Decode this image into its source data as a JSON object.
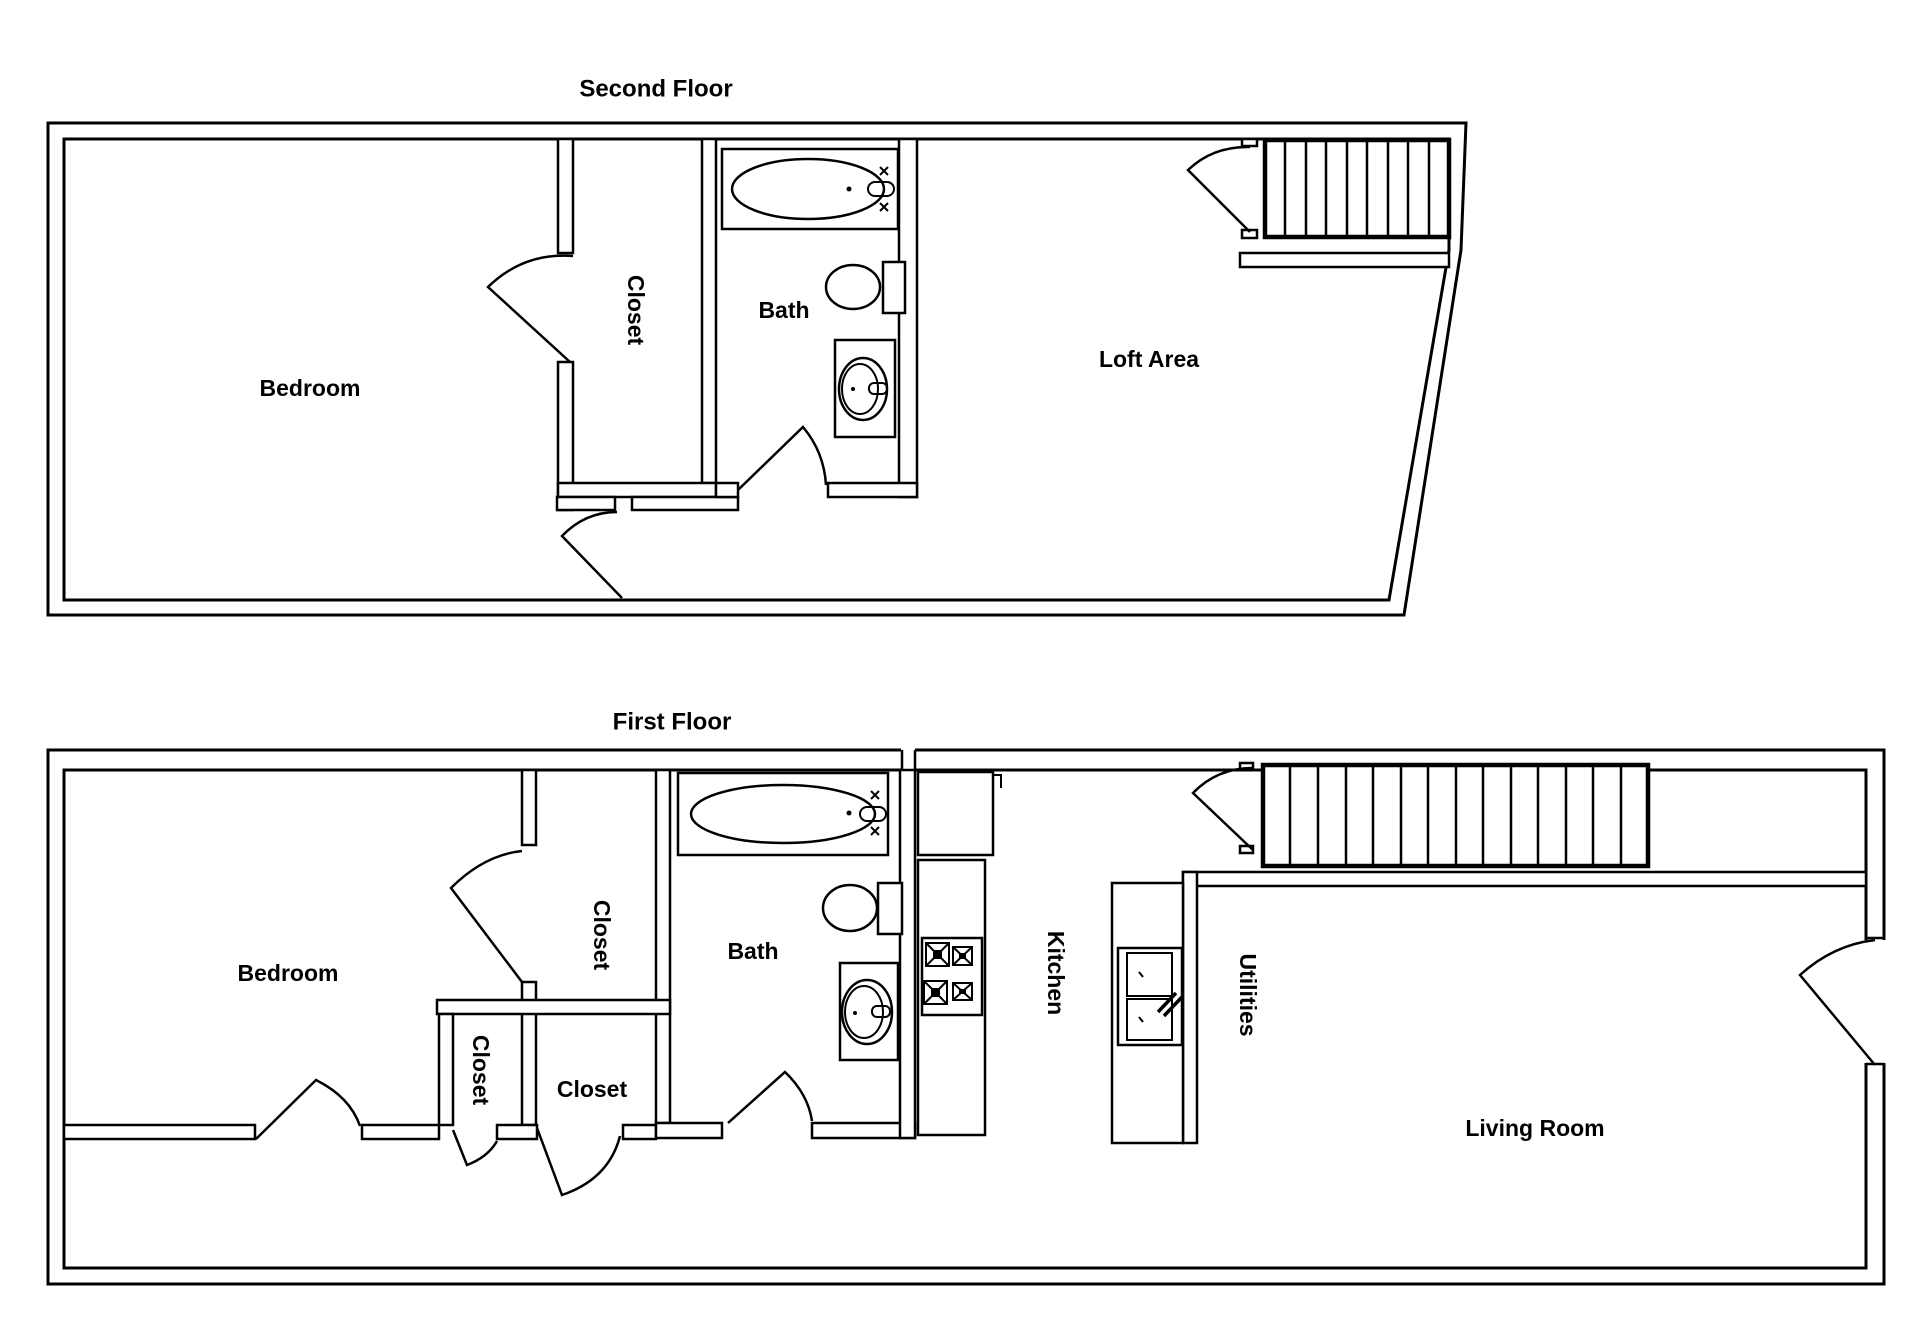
{
  "page": {
    "background": "#ffffff",
    "line_color": "#000000",
    "text_color": "#000000",
    "drawing_type": "two-story house floor plan"
  },
  "floors": [
    {
      "title": "Second Floor",
      "labels": [
        {
          "name": "bedroom",
          "text": "Bedroom"
        },
        {
          "name": "closet",
          "text": "Closet"
        },
        {
          "name": "bath",
          "text": "Bath"
        },
        {
          "name": "loft-area",
          "text": "Loft Area"
        }
      ],
      "fixtures": [
        "bathtub",
        "toilet",
        "sink",
        "staircase"
      ]
    },
    {
      "title": "First Floor",
      "labels": [
        {
          "name": "bedroom",
          "text": "Bedroom"
        },
        {
          "name": "closet-upper",
          "text": "Closet"
        },
        {
          "name": "closet-small",
          "text": "Closet"
        },
        {
          "name": "closet-center",
          "text": "Closet"
        },
        {
          "name": "bath",
          "text": "Bath"
        },
        {
          "name": "kitchen",
          "text": "Kitchen"
        },
        {
          "name": "utilities",
          "text": "Utilities"
        },
        {
          "name": "living-room",
          "text": "Living Room"
        }
      ],
      "fixtures": [
        "bathtub",
        "toilet",
        "sink",
        "stove",
        "kitchen-sink",
        "staircase"
      ]
    }
  ]
}
